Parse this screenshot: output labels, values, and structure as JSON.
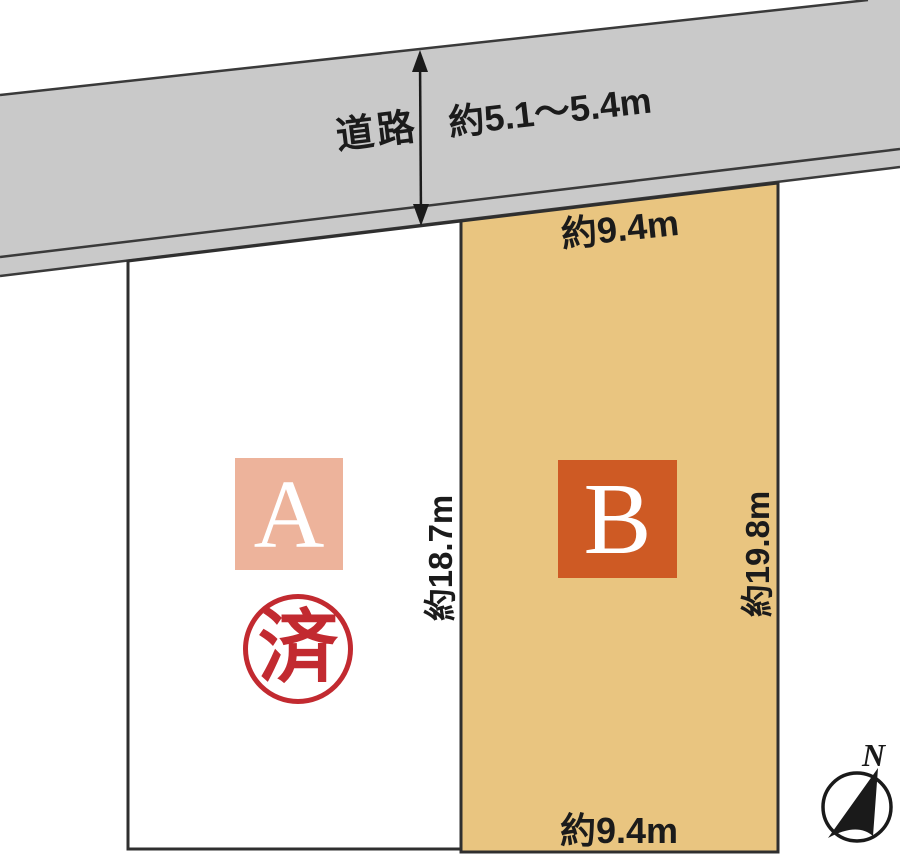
{
  "road": {
    "label": "道路",
    "width_label": "約5.1～5.4m"
  },
  "plots": {
    "a": {
      "label": "A",
      "depth_label": "約18.7m",
      "stamp_label": "済",
      "status": "sold"
    },
    "b": {
      "label": "B",
      "top_width_label": "約9.4m",
      "bottom_width_label": "約9.4m",
      "depth_label": "約19.8m"
    }
  },
  "compass": {
    "north_label": "N"
  },
  "colors": {
    "road_fill": "#C9C9C9",
    "plot_a_fill": "#FFFFFF",
    "plot_b_fill": "#E9C580",
    "plot_a_badge": "#EDB39B",
    "plot_b_badge": "#CE5A24",
    "stamp_red": "#C22A30",
    "line_dark": "#333333",
    "text_dark": "#1B1B1B"
  }
}
